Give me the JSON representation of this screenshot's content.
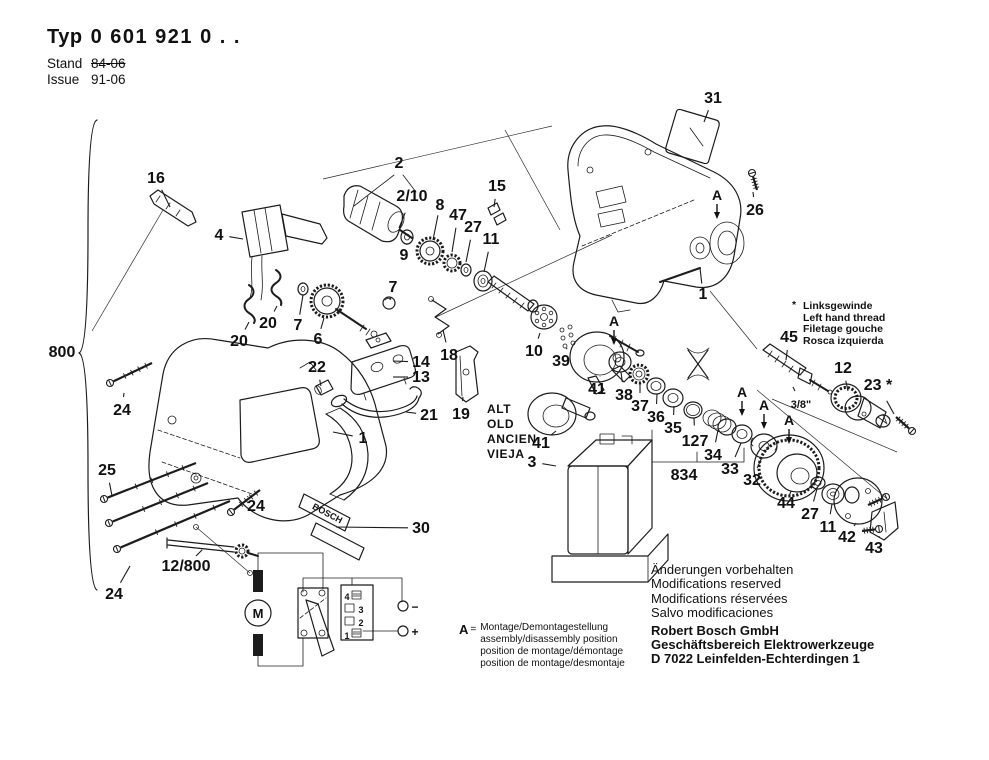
{
  "header": {
    "typ_label": "Typ",
    "typ_number": "0 601 921 0 . .",
    "stand_label": "Stand",
    "stand_value": "84-06",
    "issue_label": "Issue",
    "issue_value": "91-06"
  },
  "thread_note": {
    "symbol": "*",
    "lines": [
      "Linksgewinde",
      "Left hand thread",
      "Filetage gouche",
      "Rosca izquierda"
    ]
  },
  "old_note": {
    "lines": [
      "ALT",
      "OLD",
      "ANCIEN",
      "VIEJA"
    ]
  },
  "assembly_note": {
    "symbol": "A",
    "equals": "=",
    "lines": [
      "Montage/Demontagestellung",
      "assembly/disassembly position",
      "position de montage/démontage",
      "position de montage/desmontaje"
    ]
  },
  "footer": {
    "modifications": [
      "Änderungen vorbehalten",
      "Modifications reserved",
      "Modifications réservées",
      "Salvo modificaciones"
    ],
    "company": [
      "Robert Bosch GmbH",
      "Geschäftsbereich Elektrowerkzeuge",
      "D 7022 Leinfelden-Echterdingen 1"
    ]
  },
  "diagram": {
    "a_symbol": "A",
    "a_markers": [
      {
        "x": 717,
        "y": 200
      },
      {
        "x": 614,
        "y": 326
      },
      {
        "x": 742,
        "y": 397
      },
      {
        "x": 764,
        "y": 410
      },
      {
        "x": 789,
        "y": 425
      }
    ],
    "brand_plate": {
      "t": "BOSCH",
      "x": 326,
      "y": 516,
      "fs": 9,
      "rot": 28
    },
    "part_labels": [
      {
        "t": "16",
        "x": 156,
        "y": 183,
        "l": [
          170,
          207
        ]
      },
      {
        "t": "4",
        "x": 219,
        "y": 240,
        "l": [
          243,
          239
        ]
      },
      {
        "t": "20",
        "x": 239,
        "y": 346,
        "l": [
          249,
          322
        ]
      },
      {
        "t": "20",
        "x": 268,
        "y": 328,
        "l": [
          277,
          306
        ]
      },
      {
        "t": "800",
        "x": 62,
        "y": 357
      },
      {
        "t": "2",
        "x": 399,
        "y": 168
      },
      {
        "t": "2/10",
        "x": 412,
        "y": 201,
        "l": [
          399,
          228
        ]
      },
      {
        "t": "8",
        "x": 440,
        "y": 210,
        "l": [
          433,
          240
        ]
      },
      {
        "t": "47",
        "x": 458,
        "y": 220,
        "l": [
          452,
          252
        ]
      },
      {
        "t": "27",
        "x": 473,
        "y": 232,
        "l": [
          466,
          262
        ]
      },
      {
        "t": "11",
        "x": 491,
        "y": 244,
        "l": [
          484,
          272
        ]
      },
      {
        "t": "15",
        "x": 497,
        "y": 191,
        "l": [
          494,
          207
        ]
      },
      {
        "t": "9",
        "x": 404,
        "y": 260,
        "l": [
          407,
          244
        ]
      },
      {
        "t": "7",
        "x": 298,
        "y": 330,
        "l": [
          303,
          295
        ]
      },
      {
        "t": "6",
        "x": 318,
        "y": 344,
        "l": [
          324,
          318
        ]
      },
      {
        "t": "7",
        "x": 393,
        "y": 292,
        "l": [
          390,
          300
        ]
      },
      {
        "t": "14",
        "x": 421,
        "y": 367,
        "l": [
          393,
          361
        ]
      },
      {
        "t": "13",
        "x": 421,
        "y": 382,
        "l": [
          393,
          377
        ]
      },
      {
        "t": "18",
        "x": 449,
        "y": 360,
        "l": [
          443,
          330
        ]
      },
      {
        "t": "19",
        "x": 461,
        "y": 419,
        "l": [
          463,
          397
        ]
      },
      {
        "t": "10",
        "x": 534,
        "y": 356,
        "l": [
          540,
          333
        ]
      },
      {
        "t": "39",
        "x": 561,
        "y": 366,
        "l": [
          567,
          348
        ]
      },
      {
        "t": "41",
        "x": 597,
        "y": 394,
        "l": [
          600,
          376
        ]
      },
      {
        "t": "41",
        "x": 541,
        "y": 448,
        "l": [
          556,
          431
        ]
      },
      {
        "t": "3",
        "x": 532,
        "y": 467,
        "l": [
          556,
          466
        ]
      },
      {
        "t": "38",
        "x": 624,
        "y": 400,
        "l": [
          621,
          372
        ]
      },
      {
        "t": "37",
        "x": 640,
        "y": 411,
        "l": [
          640,
          383
        ]
      },
      {
        "t": "36",
        "x": 656,
        "y": 422,
        "l": [
          657,
          394
        ]
      },
      {
        "t": "35",
        "x": 673,
        "y": 433,
        "l": [
          674,
          406
        ]
      },
      {
        "t": "127",
        "x": 695,
        "y": 446,
        "l": [
          694,
          418
        ]
      },
      {
        "t": "34",
        "x": 713,
        "y": 460,
        "l": [
          718,
          430
        ]
      },
      {
        "t": "834",
        "x": 684,
        "y": 480
      },
      {
        "t": "33",
        "x": 730,
        "y": 474,
        "l": [
          741,
          443
        ]
      },
      {
        "t": "32",
        "x": 752,
        "y": 485,
        "l": [
          762,
          457
        ]
      },
      {
        "t": "44",
        "x": 786,
        "y": 508,
        "l": [
          789,
          496
        ]
      },
      {
        "t": "27",
        "x": 810,
        "y": 519,
        "l": [
          817,
          489
        ]
      },
      {
        "t": "11",
        "x": 828,
        "y": 532,
        "l": [
          832,
          504
        ]
      },
      {
        "t": "42",
        "x": 847,
        "y": 542,
        "l": [
          856,
          523
        ]
      },
      {
        "t": "43",
        "x": 874,
        "y": 553,
        "l": [
          879,
          537
        ]
      },
      {
        "t": "45",
        "x": 789,
        "y": 342,
        "l": [
          786,
          360
        ]
      },
      {
        "t": "12",
        "x": 843,
        "y": 373,
        "l": [
          848,
          391
        ]
      },
      {
        "t": "23 *",
        "x": 878,
        "y": 390,
        "l": [
          894,
          414
        ]
      },
      {
        "t": "26",
        "x": 755,
        "y": 215,
        "l": [
          753,
          192
        ]
      },
      {
        "t": "31",
        "x": 713,
        "y": 103,
        "l": [
          704,
          122
        ]
      },
      {
        "t": "1",
        "x": 703,
        "y": 299,
        "l": [
          700,
          268
        ]
      },
      {
        "t": "1",
        "x": 363,
        "y": 443,
        "l": [
          333,
          432
        ]
      },
      {
        "t": "21",
        "x": 429,
        "y": 420,
        "l": [
          406,
          412
        ]
      },
      {
        "t": "22",
        "x": 317,
        "y": 372,
        "l": [
          321,
          386
        ]
      },
      {
        "t": "30",
        "x": 421,
        "y": 533,
        "l": [
          336,
          527
        ]
      },
      {
        "t": "24",
        "x": 122,
        "y": 415,
        "l": [
          124,
          393
        ]
      },
      {
        "t": "25",
        "x": 107,
        "y": 475,
        "l": [
          112,
          496
        ]
      },
      {
        "t": "24",
        "x": 256,
        "y": 511,
        "l": [
          248,
          497
        ]
      },
      {
        "t": "24",
        "x": 114,
        "y": 599,
        "l": [
          130,
          566
        ]
      },
      {
        "t": "12/800",
        "x": 186,
        "y": 571,
        "l": [
          196,
          556
        ]
      },
      {
        "t": "3/8\"",
        "x": 801,
        "y": 408,
        "fs": 11,
        "l": [
          795,
          391
        ]
      }
    ]
  },
  "circuit": {
    "labels": [
      {
        "t": "M",
        "x": 258,
        "y": 618,
        "fs": 13
      },
      {
        "t": "4",
        "x": 347,
        "y": 600,
        "fs": 9
      },
      {
        "t": "3",
        "x": 361,
        "y": 613,
        "fs": 9
      },
      {
        "t": "2",
        "x": 361,
        "y": 626,
        "fs": 9
      },
      {
        "t": "1",
        "x": 347,
        "y": 639,
        "fs": 9
      },
      {
        "t": "−",
        "x": 415,
        "y": 611,
        "fs": 12
      },
      {
        "t": "+",
        "x": 415,
        "y": 636,
        "fs": 12
      }
    ]
  }
}
